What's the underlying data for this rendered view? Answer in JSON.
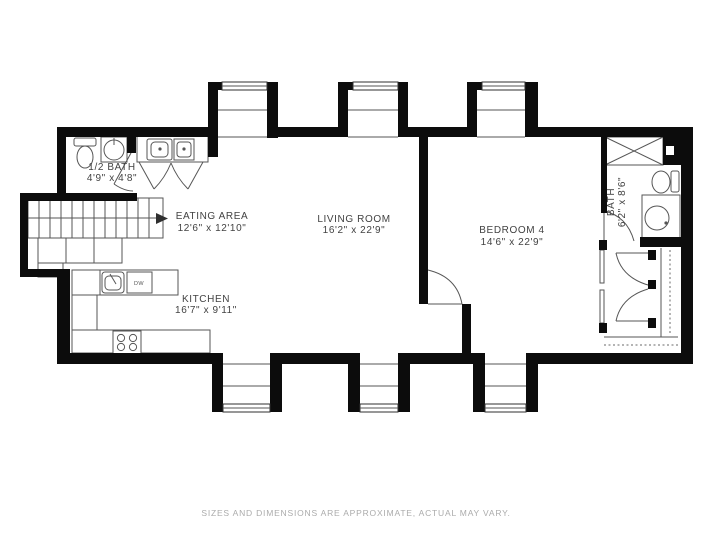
{
  "rooms": {
    "half_bath": {
      "name": "1/2 BATH",
      "dims": "4'9\" x 4'8\""
    },
    "eating_area": {
      "name": "EATING AREA",
      "dims": "12'6\" x 12'10\""
    },
    "living_room": {
      "name": "LIVING ROOM",
      "dims": "16'2\" x 22'9\""
    },
    "bedroom_4": {
      "name": "BEDROOM 4",
      "dims": "14'6\" x 22'9\""
    },
    "kitchen": {
      "name": "KITCHEN",
      "dims": "16'7\" x 9'11\""
    },
    "bath": {
      "name": "BATH",
      "dims": "6'2\" x 8'6\""
    }
  },
  "fixtures": {
    "dishwasher_label": "DW"
  },
  "footer": {
    "disclaimer": "SIZES AND DIMENSIONS ARE APPROXIMATE, ACTUAL MAY VARY."
  },
  "colors": {
    "wall": "#0c0c0c",
    "line": "#565656",
    "label": "#424242",
    "disclaimer": "#ababab",
    "background": "#ffffff"
  }
}
